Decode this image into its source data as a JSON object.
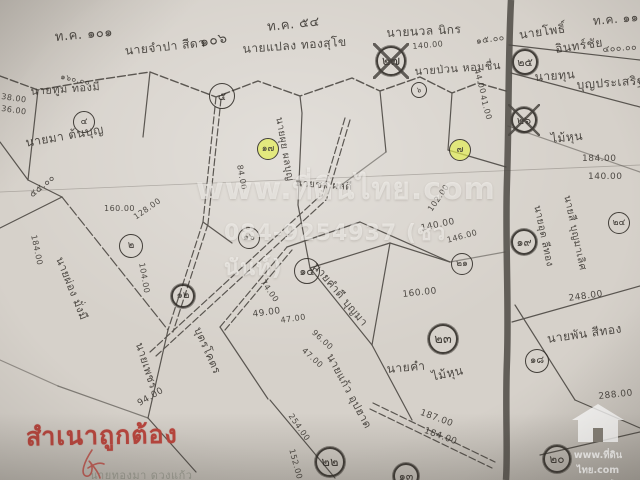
{
  "map": {
    "labels": [
      {
        "text": "ท.ค. ๑๐๑",
        "x": 54,
        "y": 26,
        "rot": -5,
        "size": 13
      },
      {
        "text": "นายจำปา สีดา",
        "x": 124,
        "y": 42,
        "rot": -6,
        "size": 12
      },
      {
        "text": "๑๐๖",
        "x": 198,
        "y": 32,
        "rot": -10,
        "size": 14
      },
      {
        "text": "นายแปลง ทองสุโข",
        "x": 242,
        "y": 40,
        "rot": -4,
        "size": 12
      },
      {
        "text": "ท.ค. ๕๔",
        "x": 266,
        "y": 16,
        "rot": -6,
        "size": 13
      },
      {
        "text": "นายนวล นิกร",
        "x": 386,
        "y": 24,
        "rot": -3,
        "size": 12
      },
      {
        "text": "ท.ค. ๑๑",
        "x": 592,
        "y": 12,
        "rot": -5,
        "size": 12
      },
      {
        "text": "นายโพธิ์",
        "x": 518,
        "y": 26,
        "rot": -8,
        "size": 12
      },
      {
        "text": "อินทร์ชัย",
        "x": 554,
        "y": 40,
        "rot": -8,
        "size": 12
      },
      {
        "text": "นายทุน",
        "x": 534,
        "y": 68,
        "rot": -4,
        "size": 12
      },
      {
        "text": "บุญประเสริฐ",
        "x": 576,
        "y": 76,
        "rot": -4,
        "size": 12
      },
      {
        "text": "นายทูม ทองมี",
        "x": 30,
        "y": 82,
        "rot": -4,
        "size": 11
      },
      {
        "text": "นายมา ต้นบุญ",
        "x": 24,
        "y": 134,
        "rot": -10,
        "size": 12
      },
      {
        "text": "นายป่วน หอมชื่น",
        "x": 414,
        "y": 62,
        "rot": -4,
        "size": 11
      },
      {
        "text": "ไม้หุน",
        "x": 550,
        "y": 130,
        "rot": -6,
        "size": 12
      },
      {
        "text": "นายผ่อง มั่งมี",
        "x": 68,
        "y": 254,
        "rot": 68,
        "size": 11
      },
      {
        "text": "นายเพชร",
        "x": 148,
        "y": 340,
        "rot": 72,
        "size": 11
      },
      {
        "text": "บุตรโคตร",
        "x": 206,
        "y": 324,
        "rot": 66,
        "size": 11
      },
      {
        "text": "นายแก้ว อุปฮาด",
        "x": 338,
        "y": 350,
        "rot": 62,
        "size": 11
      },
      {
        "text": "นายคำ",
        "x": 386,
        "y": 360,
        "rot": -5,
        "size": 12
      },
      {
        "text": "ไม้หุน",
        "x": 430,
        "y": 368,
        "rot": -12,
        "size": 12
      },
      {
        "text": "นายพัน สีทอง",
        "x": 546,
        "y": 330,
        "rot": -8,
        "size": 12
      },
      {
        "text": "นายคำดี บุญมา",
        "x": 322,
        "y": 258,
        "rot": 50,
        "size": 11
      },
      {
        "text": "นายผุย ผลบุญ",
        "x": 286,
        "y": 116,
        "rot": 80,
        "size": 10
      },
      {
        "text": "นายสี บุญมาเลิศ",
        "x": 574,
        "y": 194,
        "rot": 78,
        "size": 10
      },
      {
        "text": "นายอุด ลีทอง",
        "x": 544,
        "y": 204,
        "rot": 78,
        "size": 10
      },
      {
        "text": "นายชา ผลดี",
        "x": 296,
        "y": 176,
        "rot": 4,
        "size": 10
      },
      {
        "text": "38.00",
        "x": 2,
        "y": 92,
        "rot": 8,
        "size": 8
      },
      {
        "text": "36.00",
        "x": 2,
        "y": 104,
        "rot": 8,
        "size": 8
      },
      {
        "text": "๕๕.๐๐",
        "x": 26,
        "y": 190,
        "rot": -40,
        "size": 9
      },
      {
        "text": "184.00",
        "x": 38,
        "y": 234,
        "rot": 78,
        "size": 8
      },
      {
        "text": "๑๖๐.๐๐",
        "x": 62,
        "y": 70,
        "rot": 12,
        "size": 8
      },
      {
        "text": "160.00",
        "x": 104,
        "y": 204,
        "rot": 0,
        "size": 8
      },
      {
        "text": "128.00",
        "x": 132,
        "y": 214,
        "rot": -35,
        "size": 8
      },
      {
        "text": "104.00",
        "x": 146,
        "y": 262,
        "rot": 80,
        "size": 8
      },
      {
        "text": "84.00",
        "x": 244,
        "y": 164,
        "rot": 80,
        "size": 8
      },
      {
        "text": "49.00",
        "x": 252,
        "y": 310,
        "rot": -8,
        "size": 9
      },
      {
        "text": "47.00",
        "x": 280,
        "y": 316,
        "rot": -8,
        "size": 8
      },
      {
        "text": "74.00",
        "x": 266,
        "y": 278,
        "rot": 55,
        "size": 8
      },
      {
        "text": "96.00",
        "x": 316,
        "y": 328,
        "rot": 42,
        "size": 8
      },
      {
        "text": "47.00",
        "x": 306,
        "y": 346,
        "rot": 42,
        "size": 8
      },
      {
        "text": "254.00",
        "x": 294,
        "y": 412,
        "rot": 55,
        "size": 8
      },
      {
        "text": "187.00",
        "x": 422,
        "y": 408,
        "rot": 20,
        "size": 9
      },
      {
        "text": "184.00",
        "x": 426,
        "y": 426,
        "rot": 20,
        "size": 9
      },
      {
        "text": "152.00",
        "x": 296,
        "y": 448,
        "rot": 75,
        "size": 8
      },
      {
        "text": "94.00",
        "x": 136,
        "y": 400,
        "rot": -30,
        "size": 9
      },
      {
        "text": "160.00",
        "x": 402,
        "y": 290,
        "rot": -6,
        "size": 9
      },
      {
        "text": "140.00",
        "x": 420,
        "y": 224,
        "rot": -12,
        "size": 9
      },
      {
        "text": "146.00",
        "x": 446,
        "y": 236,
        "rot": -15,
        "size": 8
      },
      {
        "text": "102.00",
        "x": 426,
        "y": 208,
        "rot": -55,
        "size": 8
      },
      {
        "text": "140.00",
        "x": 412,
        "y": 42,
        "rot": -5,
        "size": 8
      },
      {
        "text": "๑๕.๐๐",
        "x": 475,
        "y": 34,
        "rot": -8,
        "size": 9
      },
      {
        "text": "๔๐๐.๐๐",
        "x": 602,
        "y": 42,
        "rot": -4,
        "size": 9
      },
      {
        "text": "44.00",
        "x": 481,
        "y": 68,
        "rot": 75,
        "size": 8
      },
      {
        "text": "41.00",
        "x": 487,
        "y": 94,
        "rot": 75,
        "size": 8
      },
      {
        "text": "184.00",
        "x": 582,
        "y": 154,
        "rot": 0,
        "size": 9
      },
      {
        "text": "140.00",
        "x": 588,
        "y": 172,
        "rot": 0,
        "size": 9
      },
      {
        "text": "248.00",
        "x": 568,
        "y": 294,
        "rot": -8,
        "size": 9
      },
      {
        "text": "288.00",
        "x": 598,
        "y": 392,
        "rot": -6,
        "size": 9
      },
      {
        "text": "นายทองมา ดวงแก้ว",
        "x": 90,
        "y": 466,
        "rot": 0,
        "size": 11,
        "style": "faint"
      }
    ],
    "plots": [
      {
        "num": "๕",
        "x": 222,
        "y": 96,
        "d": 26,
        "highlight": false,
        "bold": false,
        "crossed": false
      },
      {
        "num": "๔",
        "x": 84,
        "y": 122,
        "d": 22,
        "highlight": false,
        "bold": false,
        "crossed": false
      },
      {
        "num": "๑๗",
        "x": 268,
        "y": 149,
        "d": 22,
        "highlight": true,
        "bold": false,
        "crossed": false
      },
      {
        "num": "๗",
        "x": 460,
        "y": 150,
        "d": 22,
        "highlight": true,
        "bold": false,
        "crossed": false
      },
      {
        "num": "๒๗",
        "x": 391,
        "y": 61,
        "d": 30,
        "highlight": false,
        "bold": true,
        "crossed": true
      },
      {
        "num": "๒๕",
        "x": 525,
        "y": 62,
        "d": 26,
        "highlight": false,
        "bold": true,
        "crossed": false
      },
      {
        "num": "๒๖",
        "x": 524,
        "y": 120,
        "d": 26,
        "highlight": false,
        "bold": true,
        "crossed": true
      },
      {
        "num": "๖",
        "x": 419,
        "y": 90,
        "d": 16,
        "highlight": false,
        "bold": false,
        "crossed": false
      },
      {
        "num": "๒",
        "x": 131,
        "y": 246,
        "d": 24,
        "highlight": false,
        "bold": false,
        "crossed": false
      },
      {
        "num": "๑๖",
        "x": 249,
        "y": 238,
        "d": 22,
        "highlight": false,
        "bold": false,
        "crossed": false
      },
      {
        "num": "๑๕",
        "x": 307,
        "y": 271,
        "d": 26,
        "highlight": false,
        "bold": false,
        "crossed": false
      },
      {
        "num": "๑๒",
        "x": 183,
        "y": 296,
        "d": 24,
        "highlight": false,
        "bold": true,
        "crossed": false
      },
      {
        "num": "๒๑",
        "x": 462,
        "y": 264,
        "d": 22,
        "highlight": false,
        "bold": false,
        "crossed": false
      },
      {
        "num": "๑๙",
        "x": 524,
        "y": 242,
        "d": 26,
        "highlight": false,
        "bold": true,
        "crossed": false
      },
      {
        "num": "๒๓",
        "x": 443,
        "y": 339,
        "d": 30,
        "highlight": false,
        "bold": true,
        "crossed": false
      },
      {
        "num": "๑๘",
        "x": 537,
        "y": 361,
        "d": 24,
        "highlight": false,
        "bold": false,
        "crossed": false
      },
      {
        "num": "๒๒",
        "x": 330,
        "y": 462,
        "d": 30,
        "highlight": false,
        "bold": true,
        "crossed": false
      },
      {
        "num": "๑๓",
        "x": 406,
        "y": 476,
        "d": 26,
        "highlight": false,
        "bold": true,
        "crossed": false
      },
      {
        "num": "๒๐",
        "x": 557,
        "y": 459,
        "d": 28,
        "highlight": false,
        "bold": true,
        "crossed": false
      },
      {
        "num": "๒๔",
        "x": 619,
        "y": 223,
        "d": 22,
        "highlight": false,
        "bold": false,
        "crossed": false
      }
    ]
  },
  "watermark": {
    "line1": "www.ที่ดินไทย.com",
    "line2": "084-9254937 (ชวนันท์)"
  },
  "stamp": {
    "text": "สำเนาถูกต้อง"
  },
  "corner_logo": {
    "icon": "house-icon",
    "site": "www.ที่ดินไทย.com",
    "tagline": "อสังหาริมทรัพย์ ซื้อ-ขาย"
  },
  "colors": {
    "paper": "#d6d1ca",
    "ink": "#3b3732",
    "highlight": "#e4ee54",
    "stamp_red": "#b5443c"
  }
}
